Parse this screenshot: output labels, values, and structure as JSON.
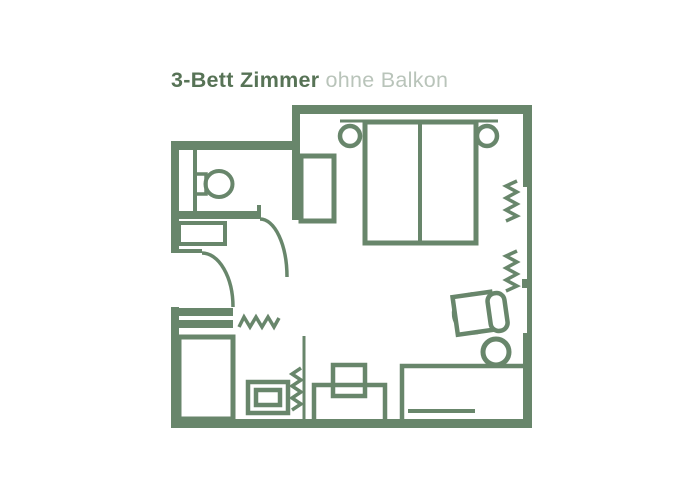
{
  "page": {
    "width": 700,
    "height": 500,
    "background": "#ffffff"
  },
  "header": {
    "title_bold": "3-Bett Zimmer",
    "title_light": "ohne Balkon"
  },
  "colors": {
    "plan_green": "#68866b",
    "title_green": "#577356",
    "subtitle_green": "#b9c4ba",
    "page_bg": "#ffffff"
  },
  "floorplan": {
    "furniture": [
      "double-bed",
      "bed-divider",
      "headboard",
      "bedside-lamp-left",
      "bedside-lamp-right",
      "closet",
      "wardrobe",
      "toilet",
      "washbasin-shelf",
      "entrance-door",
      "bathroom-door",
      "shoe-shelf",
      "minibar",
      "tv",
      "tv-stand",
      "desk",
      "desk-drawer",
      "office-chair",
      "stool",
      "curtain-window-1",
      "curtain-window-2",
      "entry-zigzag",
      "tv-zigzag",
      "partition-line"
    ]
  }
}
